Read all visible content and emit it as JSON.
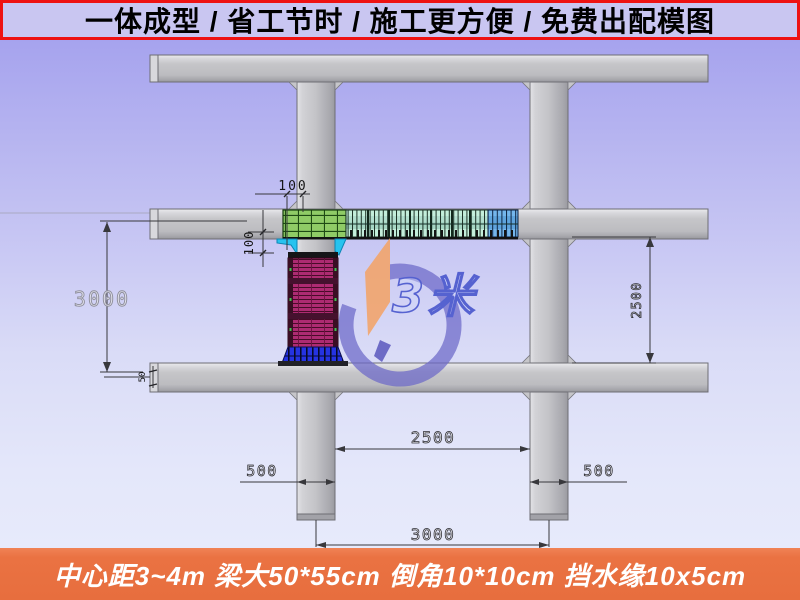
{
  "banner": {
    "text": "一体成型 / 省工节时 / 施工更方便 / 免费出配模图",
    "bg_color": "#c9c6f1",
    "border_color": "#ee1212"
  },
  "footer": {
    "text": "中心距3~4m 梁大50*55cm 倒角10*10cm 挡水缘10x5cm",
    "bg_color": "#e76e3e"
  },
  "watermark": {
    "text": "3米"
  },
  "dimensions": {
    "panel_overhang": "100",
    "haunch_drop": "100",
    "left_bay_height": "3000",
    "curb_height": "50",
    "right_clear_height": "2500",
    "bottom_clear_span": "2500",
    "beam_width_left": "500",
    "beam_width_right": "500",
    "center_spacing": "3000"
  },
  "colors": {
    "beam_gray": "#c3c3c7",
    "panel_green": "#8fcb66",
    "panel_mint": "#c2ecd9",
    "panel_blue": "#6cb0e8",
    "haunch_cyan": "#27c3ef",
    "column_magenta": "#ad2b72",
    "column_base_blue": "#2533e2",
    "watermark_orange": "#f3a469",
    "watermark_blue": "#6b68c8"
  }
}
